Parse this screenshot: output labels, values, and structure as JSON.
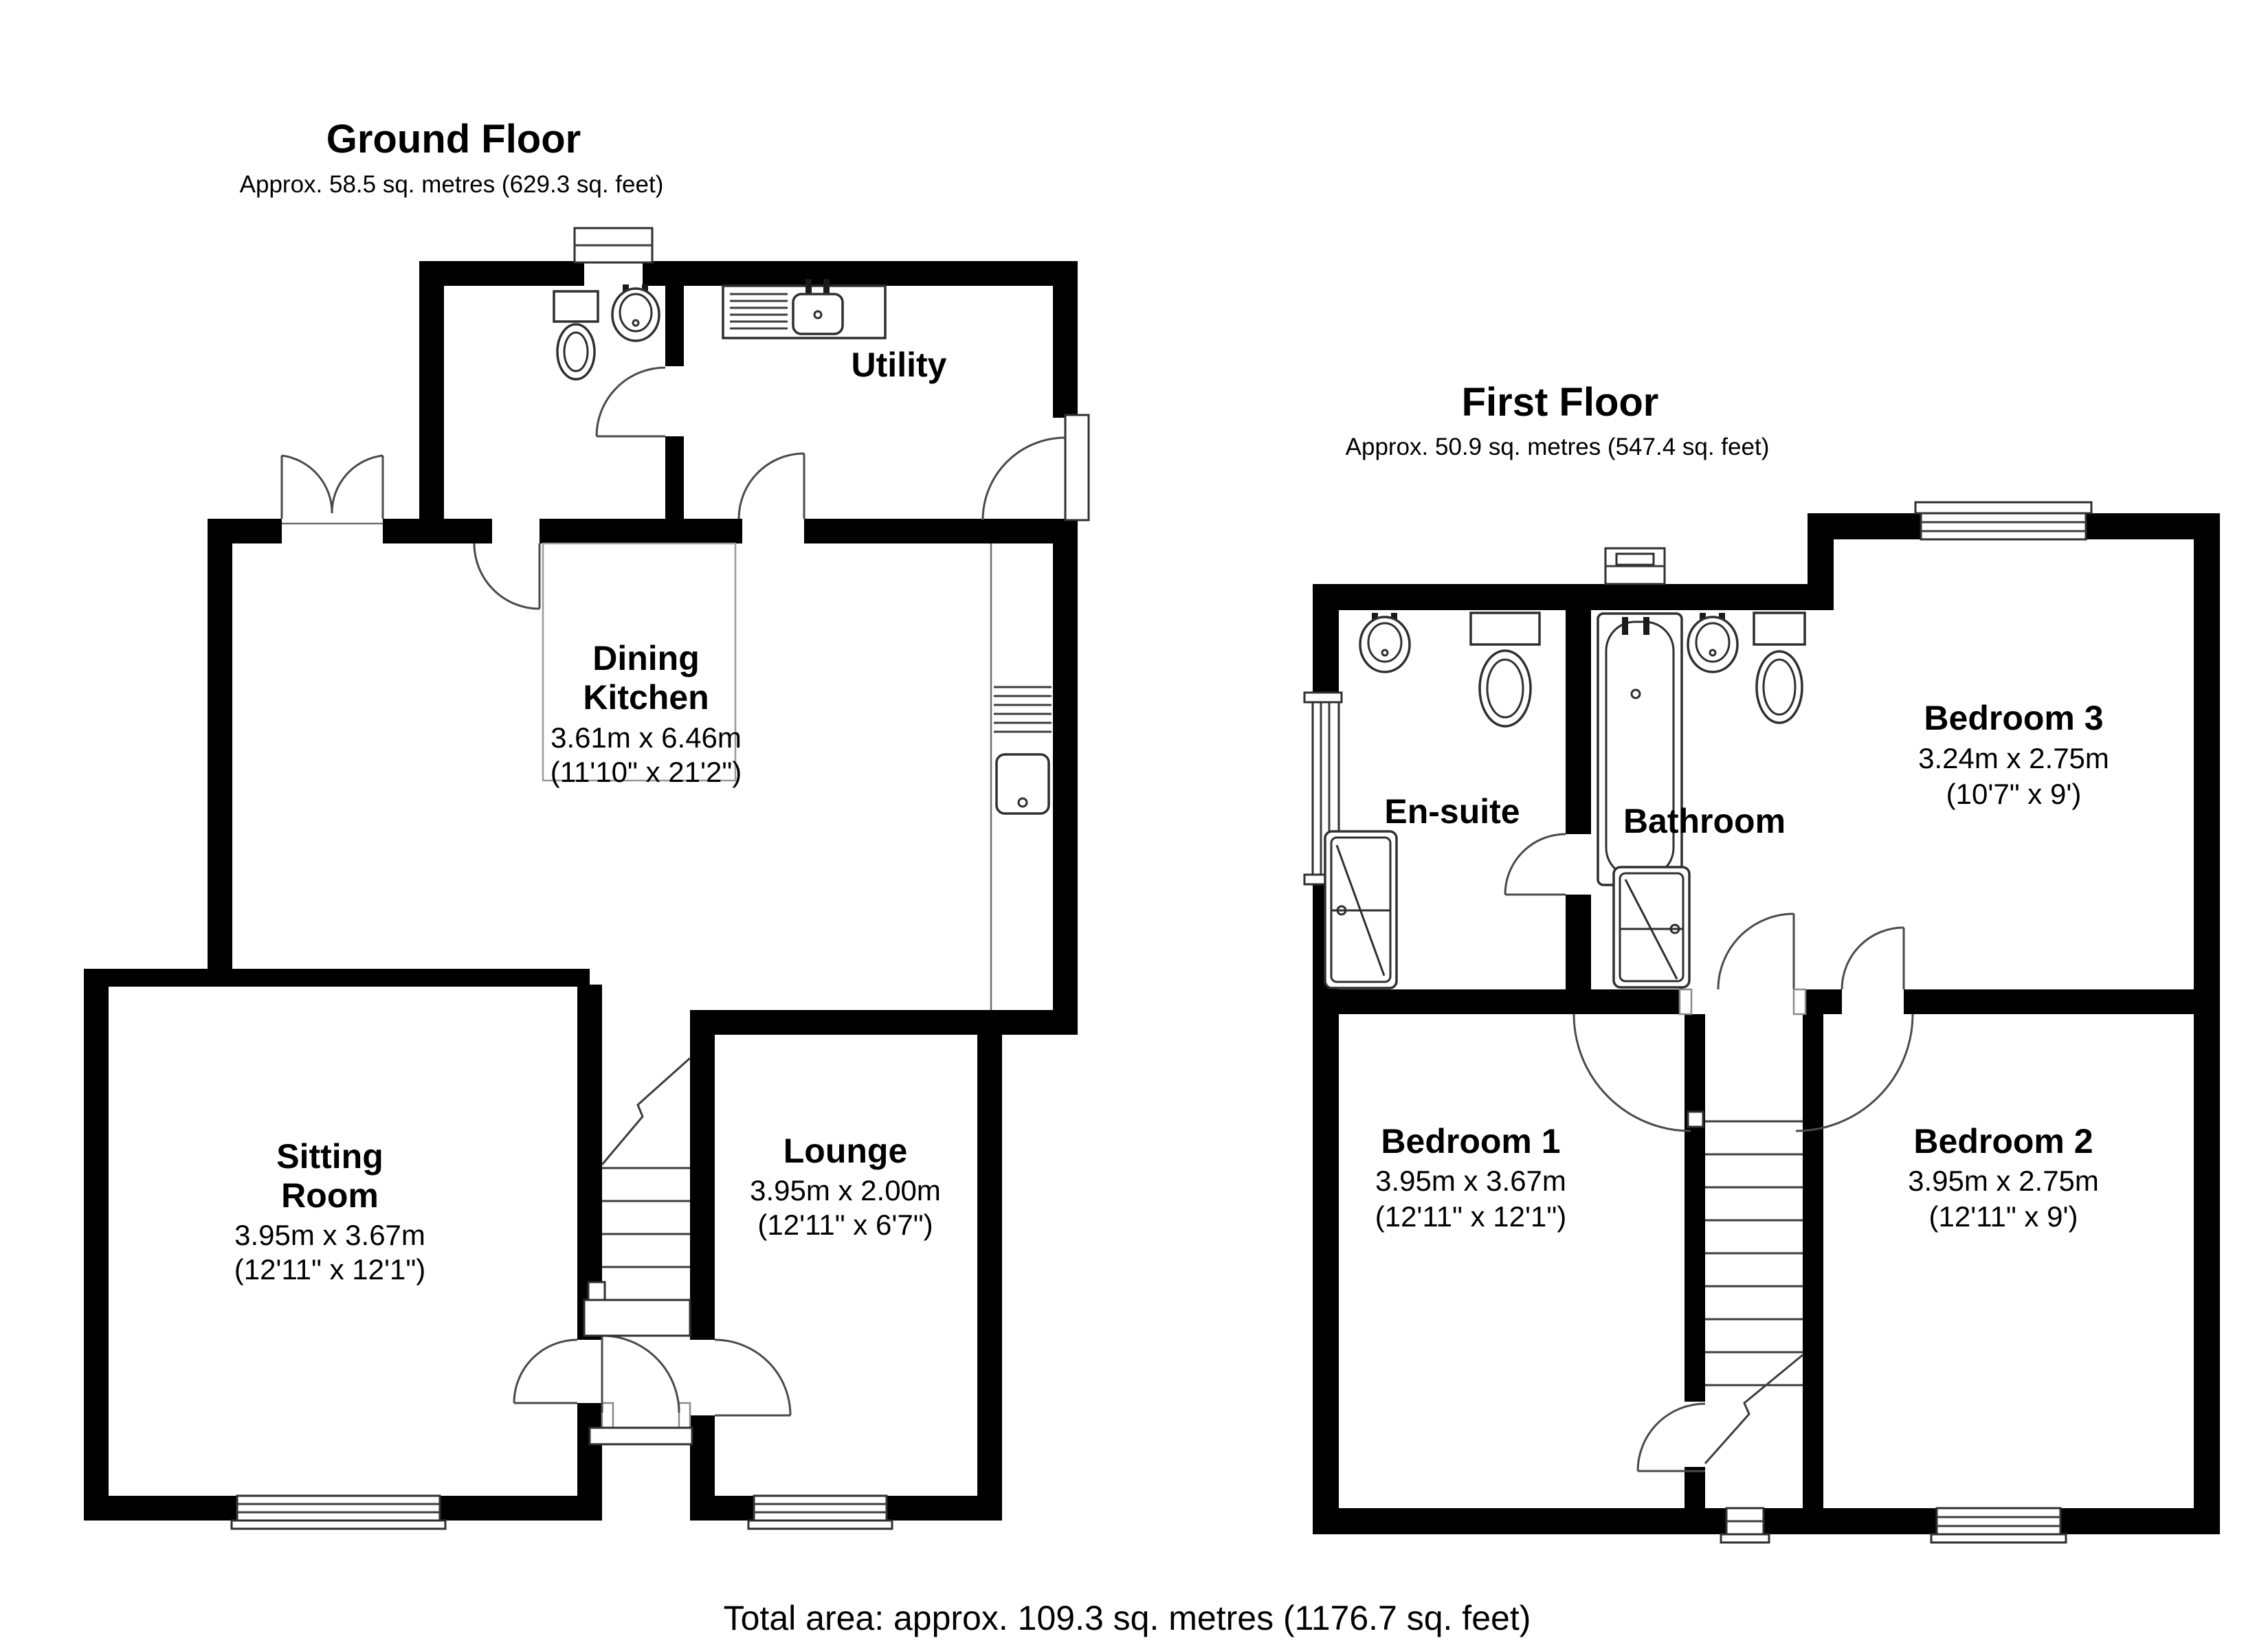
{
  "colors": {
    "wall": "#000000",
    "line": "#3d3d3d",
    "zone_outline": "#9a9a9a",
    "background": "#ffffff"
  },
  "ground_floor": {
    "title": "Ground Floor",
    "subtitle": "Approx. 58.5 sq. metres (629.3 sq. feet)",
    "rooms": {
      "utility": {
        "name": "Utility"
      },
      "dining_kitchen": {
        "line1": "Dining",
        "line2": "Kitchen",
        "metric": "3.61m x 6.46m",
        "imperial": "(11'10\" x 21'2\")"
      },
      "sitting_room": {
        "line1": "Sitting",
        "line2": "Room",
        "metric": "3.95m x 3.67m",
        "imperial": "(12'11\" x 12'1\")"
      },
      "lounge": {
        "name": "Lounge",
        "metric": "3.95m x 2.00m",
        "imperial": "(12'11\" x 6'7\")"
      }
    }
  },
  "first_floor": {
    "title": "First Floor",
    "subtitle": "Approx. 50.9 sq. metres (547.4 sq. feet)",
    "rooms": {
      "en_suite": {
        "name": "En-suite"
      },
      "bathroom": {
        "name": "Bathroom"
      },
      "bedroom3": {
        "name": "Bedroom 3",
        "metric": "3.24m x 2.75m",
        "imperial": "(10'7\" x 9')"
      },
      "bedroom1": {
        "name": "Bedroom 1",
        "metric": "3.95m x 3.67m",
        "imperial": "(12'11\" x 12'1\")"
      },
      "bedroom2": {
        "name": "Bedroom 2",
        "metric": "3.95m x 2.75m",
        "imperial": "(12'11\" x 9')"
      }
    }
  },
  "footer": {
    "total_area": "Total area: approx. 109.3 sq. metres (1176.7 sq. feet)"
  }
}
